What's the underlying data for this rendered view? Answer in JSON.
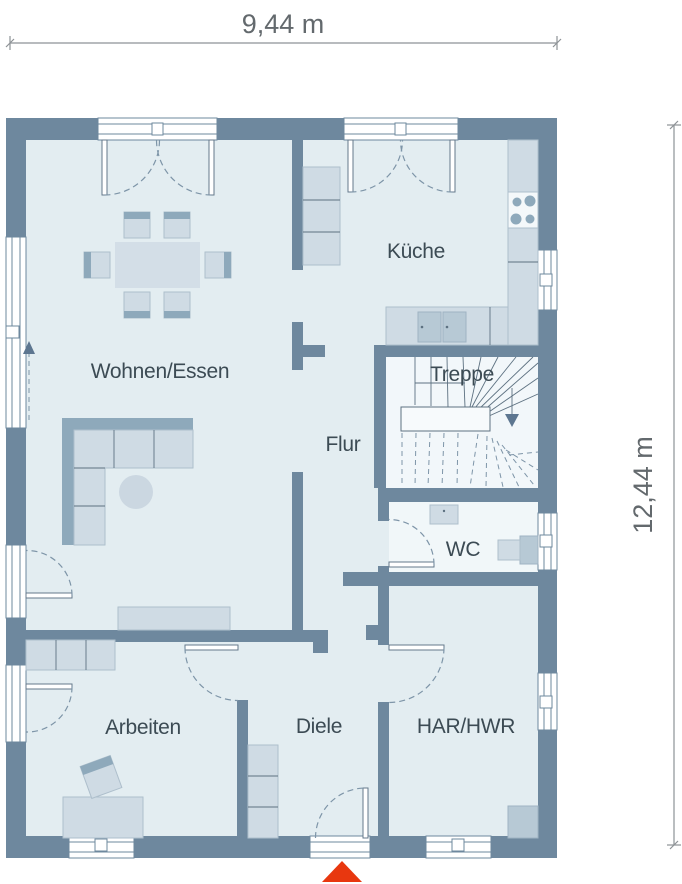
{
  "plan": {
    "title": "Erdgeschoss Grundriss",
    "dimensions": {
      "width_label": "9,44 m",
      "height_label": "12,44 m"
    },
    "rooms": {
      "living_dining": "Wohnen/Essen",
      "kitchen": "Küche",
      "staircase": "Treppe",
      "hallway": "Flur",
      "wc": "WC",
      "office": "Arbeiten",
      "foyer": "Diele",
      "utility": "HAR/HWR"
    },
    "colors": {
      "wall": "#6e889e",
      "floor": "#e3edf1",
      "floor_light": "#f2f7fa",
      "furniture": "#cfdbe4",
      "furniture_dark": "#8ea9bb",
      "entrance_red": "#e8370f",
      "label_text": "#3c4b54",
      "dimension_text": "#63696d"
    },
    "markers": {
      "entrance": "entrance-arrow-red-triangle",
      "stair_direction": "down-arrow",
      "sliding_door_direction": "up-arrow"
    }
  }
}
